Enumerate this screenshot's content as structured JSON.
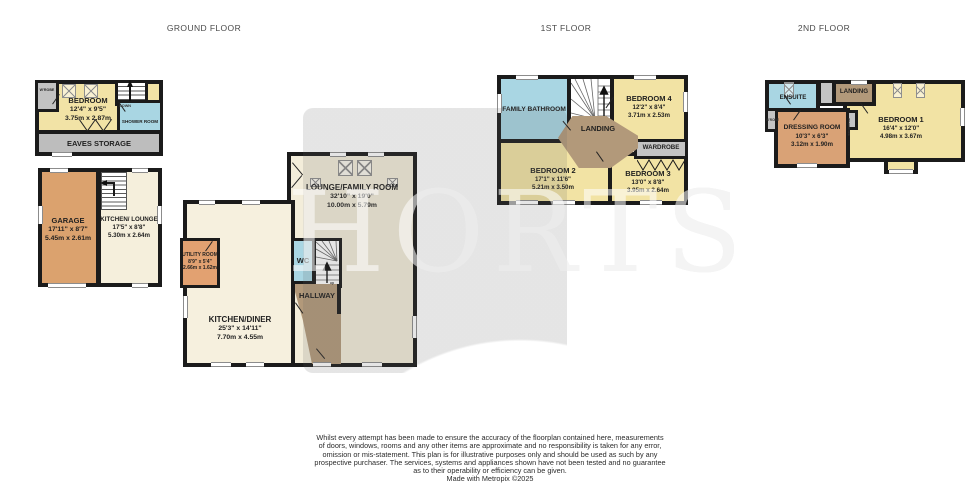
{
  "titles": {
    "ground": "GROUND FLOOR",
    "first": "1ST FLOOR",
    "second": "2ND FLOOR"
  },
  "watermark": {
    "text": "HORTS"
  },
  "colors": {
    "wall": "#1b1b1b",
    "room_yellow": "#F2E3A4",
    "room_cream": "#F5EFDC",
    "room_blue": "#A9D6E3",
    "room_brown": "#B2997A",
    "room_orange": "#DBA26E",
    "room_tan": "#D9A276",
    "storage_gray": "#C2C2C2"
  },
  "annexe_upper": {
    "bedroom_name": "BEDROOM",
    "bedroom_imp": "12'4\" x 9'5\"",
    "bedroom_met": "3.75m x 2.87m",
    "shower": "SHOWER ROOM",
    "eaves": "EAVES STORAGE",
    "wardrobe": "W'ROBE",
    "stairs_dir": "DOWN"
  },
  "annexe_ground": {
    "garage_name": "GARAGE",
    "garage_imp": "17'11\" x 8'7\"",
    "garage_met": "5.45m x 2.61m",
    "kitchen_name": "KITCHEN/ LOUNGE",
    "kitchen_imp": "17'5\" x 8'8\"",
    "kitchen_met": "5.30m x 2.64m"
  },
  "ground": {
    "lounge_name": "LOUNGE/FAMILY ROOM",
    "lounge_imp": "32'10\" x 19'0\"",
    "lounge_met": "10.00m x 5.79m",
    "kitchen_name": "KITCHEN/DINER",
    "kitchen_imp": "25'3\" x 14'11\"",
    "kitchen_met": "7.70m x 4.55m",
    "utility_name": "UTILITY ROOM",
    "utility_imp": "8'9\" x 5'4\"",
    "utility_met": "2.66m x 1.62m",
    "wc": "WC",
    "hallway": "HALLWAY",
    "stairs_dir": "up"
  },
  "first": {
    "bathroom": "FAMILY BATHROOM",
    "landing": "LANDING",
    "wardrobe": "WARDROBE",
    "bed4_name": "BEDROOM 4",
    "bed4_imp": "12'2\" x 8'4\"",
    "bed4_met": "3.71m x 2.53m",
    "bed2_name": "BEDROOM 2",
    "bed2_imp": "17'1\" x 11'6\"",
    "bed2_met": "5.21m x 3.50m",
    "bed3_name": "BEDROOM 3",
    "bed3_imp": "13'0\" x 8'8\"",
    "bed3_met": "3.95m x 2.64m"
  },
  "second": {
    "ensuite": "ENSUITE",
    "landing": "LANDING",
    "bed1_name": "BEDROOM 1",
    "bed1_imp": "16'4\" x 12'0\"",
    "bed1_met": "4.98m x 3.67m",
    "dressing_name": "DRESSING ROOM",
    "dressing_imp": "10'3\" x 6'3\"",
    "dressing_met": "3.12m x 1.90m",
    "wrobe_small": "W'ROBE",
    "wardrobe_small": "WARDROBE"
  },
  "disclaimer": {
    "l1": "Whilst every attempt has been made to ensure the accuracy of the floorplan contained here, measurements",
    "l2": "of doors, windows, rooms and any other items are approximate and no responsibility is taken for any error,",
    "l3": "omission or mis-statement. This plan is for illustrative purposes only and should be used as such by any",
    "l4": "prospective purchaser. The services, systems and appliances shown have not been tested and no guarantee",
    "l5": "as to their operability or efficiency can be given.",
    "l6": "Made with Metropix ©2025"
  }
}
